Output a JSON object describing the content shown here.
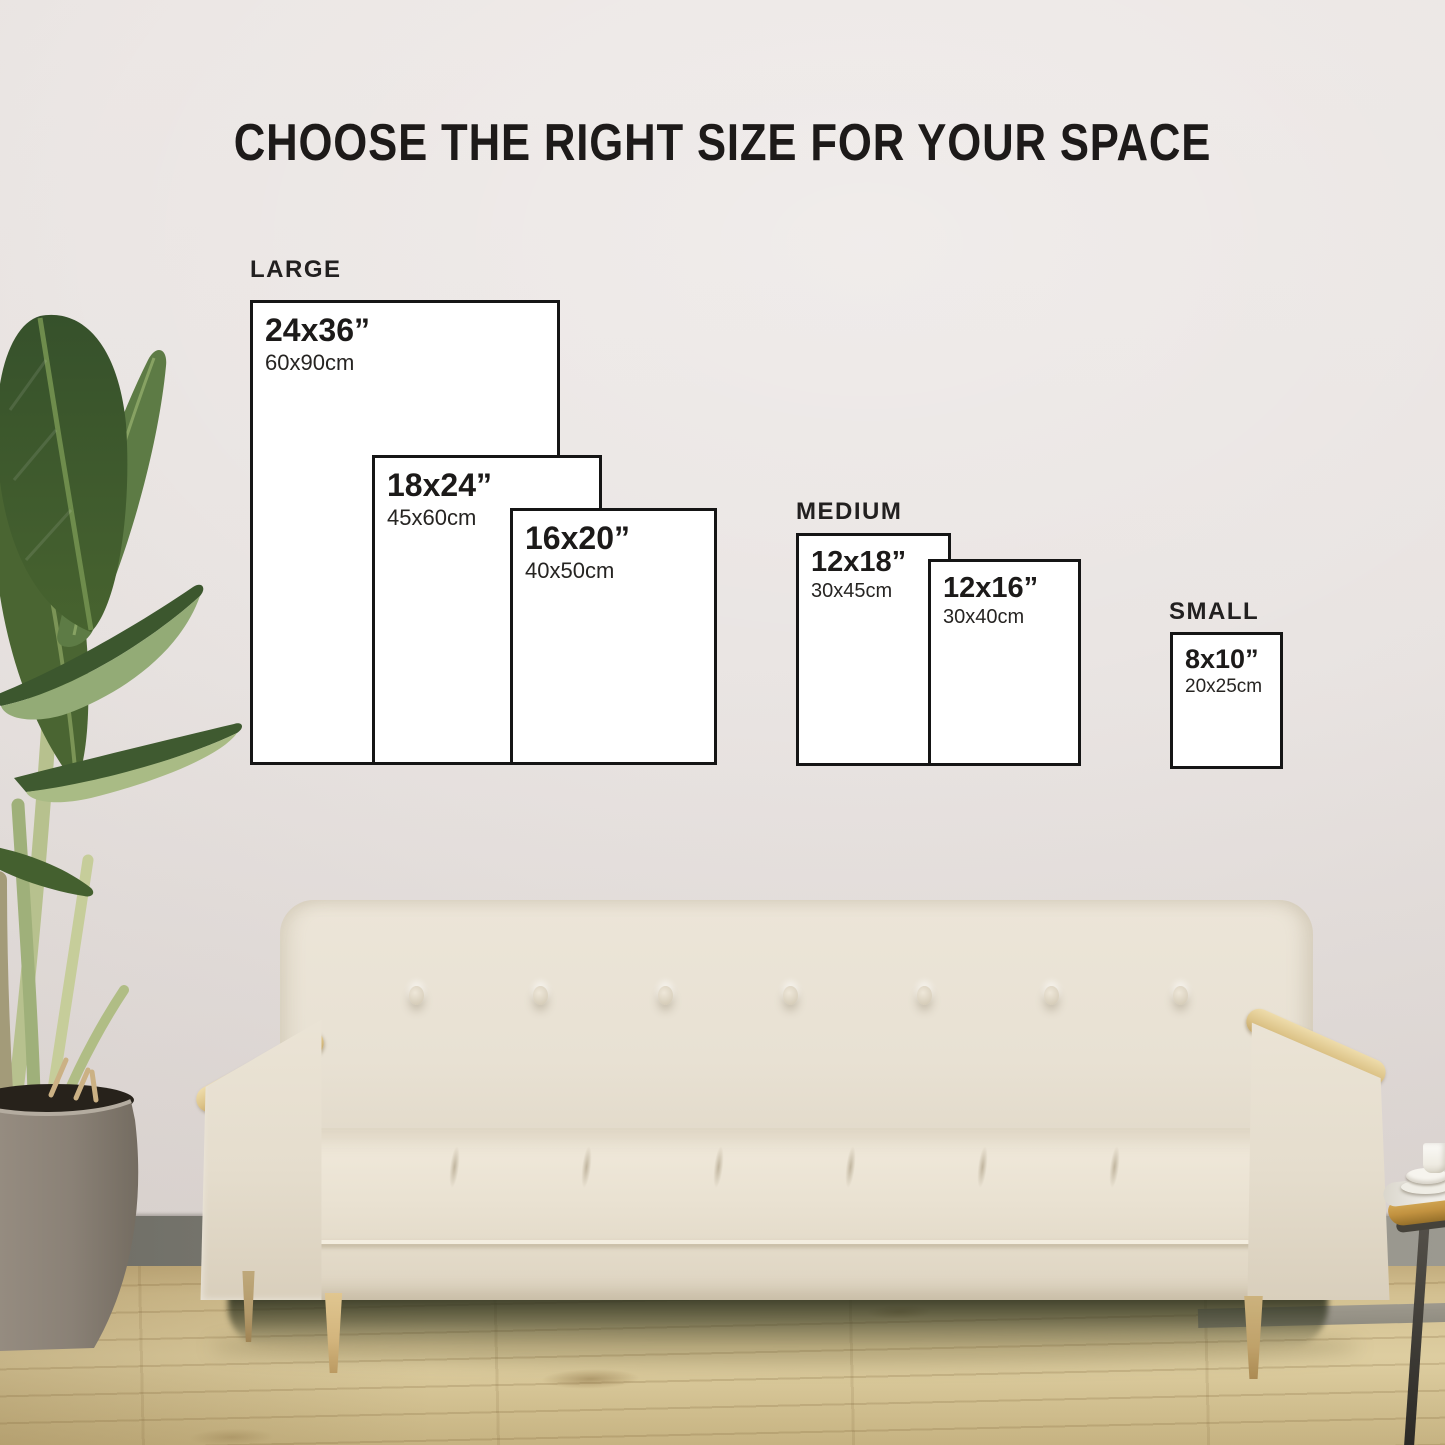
{
  "title": "CHOOSE THE RIGHT SIZE FOR YOUR SPACE",
  "groups": [
    {
      "label": "LARGE",
      "sizes": [
        {
          "inches": "24x36”",
          "cm": "60x90cm"
        },
        {
          "inches": "18x24”",
          "cm": "45x60cm"
        },
        {
          "inches": "16x20”",
          "cm": "40x50cm"
        }
      ]
    },
    {
      "label": "MEDIUM",
      "sizes": [
        {
          "inches": "12x18”",
          "cm": "30x45cm"
        },
        {
          "inches": "12x16”",
          "cm": "30x40cm"
        }
      ]
    },
    {
      "label": "SMALL",
      "sizes": [
        {
          "inches": "8x10”",
          "cm": "20x25cm"
        }
      ]
    }
  ],
  "scene": {
    "colors": {
      "wall": "#e9e4e2",
      "floor_wood": "#d8c695",
      "baseboard": "#807f77",
      "sofa_fabric": "#e9e2d4",
      "armrest_wood": "#dcc489",
      "plant_leaf": "#47622f",
      "planter_pot": "#8b8277",
      "box_fill": "#ffffff",
      "box_border": "#151515",
      "text": "#1d1a19",
      "table_brass": "#c29240"
    }
  }
}
